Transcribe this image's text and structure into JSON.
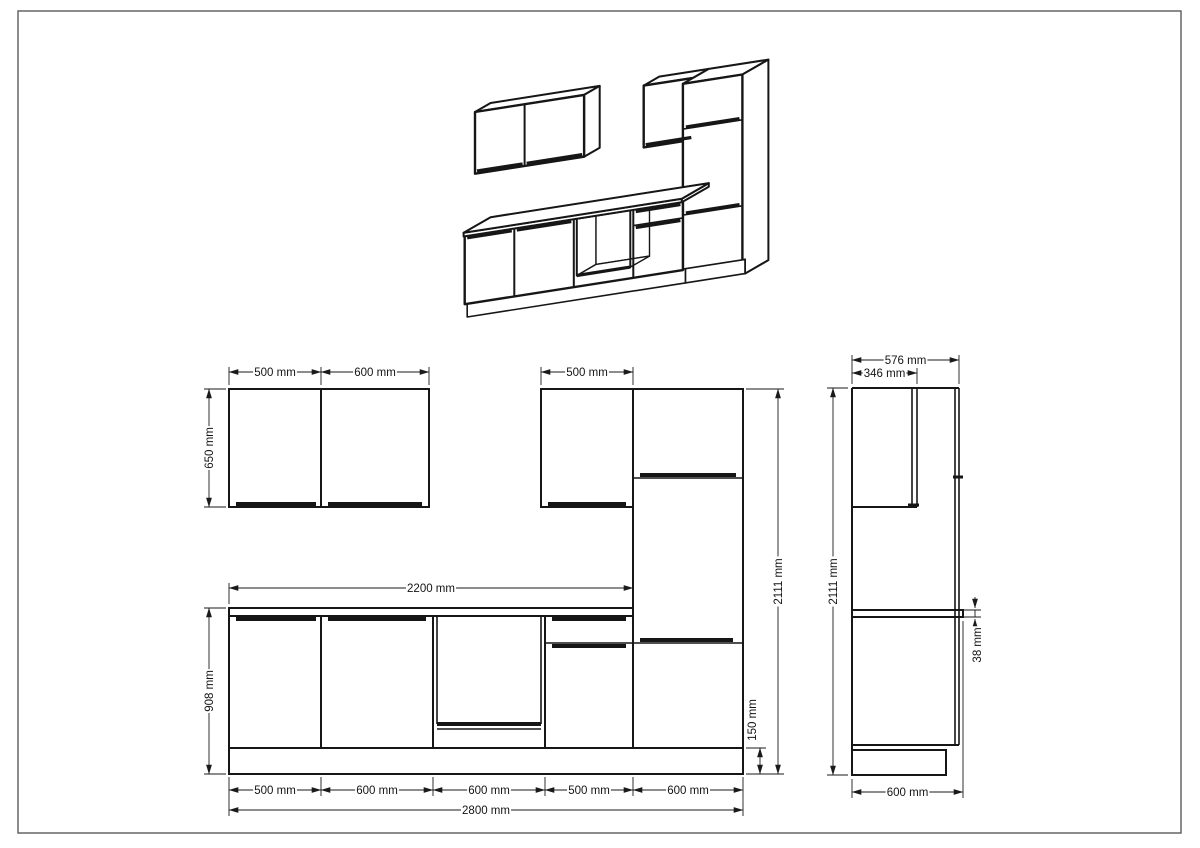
{
  "meta": {
    "title": "Kitchen cabinet set technical drawing",
    "views": [
      "oblique-3d-view",
      "front-elevation",
      "side-elevation"
    ]
  },
  "page": {
    "bg": "#ffffff",
    "border_color": "#5b5b5b",
    "ink": "#161616",
    "dim_ink": "#1a1a1a",
    "frame": [
      18,
      11,
      1163,
      822
    ],
    "font_size": 11.5
  },
  "dimensions": {
    "front_horizontal": [
      {
        "y": 372,
        "x1": 229,
        "x2": 321,
        "label": "500 mm"
      },
      {
        "y": 372,
        "x1": 321,
        "x2": 429,
        "label": "600 mm"
      },
      {
        "y": 372,
        "x1": 541,
        "x2": 633,
        "label": "500 mm"
      },
      {
        "y": 588,
        "x1": 229,
        "x2": 633,
        "label": "2200 mm"
      },
      {
        "y": 790,
        "x1": 229,
        "x2": 321,
        "label": "500 mm"
      },
      {
        "y": 790,
        "x1": 321,
        "x2": 433,
        "label": "600 mm"
      },
      {
        "y": 790,
        "x1": 433,
        "x2": 545,
        "label": "600 mm"
      },
      {
        "y": 790,
        "x1": 545,
        "x2": 633,
        "label": "500 mm"
      },
      {
        "y": 790,
        "x1": 633,
        "x2": 743,
        "label": "600 mm"
      },
      {
        "y": 810,
        "x1": 229,
        "x2": 743,
        "label": "2800 mm"
      }
    ],
    "front_vertical": [
      {
        "x": 209,
        "y1": 389,
        "y2": 507,
        "label": "650 mm"
      },
      {
        "x": 209,
        "y1": 608,
        "y2": 774,
        "label": "908 mm"
      },
      {
        "x": 778,
        "y1": 389,
        "y2": 774,
        "label": "2111 mm"
      },
      {
        "x": 760,
        "y1": 748,
        "y2": 774,
        "label": "150 mm",
        "lx": 752,
        "ly": 720
      }
    ],
    "side_horizontal": [
      {
        "y": 360,
        "x1": 852,
        "x2": 959,
        "label": "576 mm"
      },
      {
        "y": 373,
        "x1": 852,
        "x2": 917,
        "label": "346 mm"
      },
      {
        "y": 792,
        "x1": 852,
        "x2": 963,
        "label": "600 mm"
      }
    ],
    "side_vertical": [
      {
        "x": 833,
        "y1": 388,
        "y2": 775,
        "label": "2111 mm"
      },
      {
        "x": 975,
        "y1": 610,
        "y2": 617,
        "label": "38 mm",
        "lx": 977,
        "ly": 645,
        "outside": true
      }
    ]
  },
  "extensions": [
    [
      229,
      385,
      229,
      367
    ],
    [
      321,
      385,
      321,
      367
    ],
    [
      429,
      385,
      429,
      367
    ],
    [
      541,
      385,
      541,
      367
    ],
    [
      633,
      385,
      633,
      367
    ],
    [
      229,
      604,
      229,
      583
    ],
    [
      633,
      604,
      633,
      583
    ],
    [
      226,
      389,
      204,
      389
    ],
    [
      226,
      507,
      204,
      507
    ],
    [
      226,
      608,
      204,
      608
    ],
    [
      226,
      774,
      204,
      774
    ],
    [
      746,
      389,
      784,
      389
    ],
    [
      746,
      774,
      784,
      774
    ],
    [
      746,
      748,
      766,
      748
    ],
    [
      229,
      777,
      229,
      816
    ],
    [
      321,
      777,
      321,
      796
    ],
    [
      433,
      777,
      433,
      796
    ],
    [
      545,
      777,
      545,
      796
    ],
    [
      633,
      777,
      633,
      796
    ],
    [
      743,
      777,
      743,
      816
    ],
    [
      852,
      384,
      852,
      355
    ],
    [
      959,
      384,
      959,
      355
    ],
    [
      917,
      384,
      917,
      368
    ],
    [
      848,
      388,
      827,
      388
    ],
    [
      848,
      775,
      827,
      775
    ],
    [
      852,
      779,
      852,
      798
    ],
    [
      963,
      621,
      963,
      798
    ],
    [
      963,
      610,
      981,
      610
    ],
    [
      963,
      617,
      981,
      617
    ]
  ],
  "arrow_stubs": [
    [
      975,
      597,
      975,
      608
    ],
    [
      975,
      630,
      975,
      619
    ]
  ],
  "front_view": {
    "rects": [
      [
        229,
        389,
        92,
        118
      ],
      [
        321,
        389,
        108,
        118
      ],
      [
        541,
        389,
        92,
        118
      ],
      [
        633,
        389,
        110,
        359
      ],
      [
        229,
        616,
        92,
        132
      ],
      [
        321,
        616,
        112,
        132
      ],
      [
        433,
        616,
        112,
        132
      ],
      [
        545,
        616,
        88,
        132
      ],
      [
        229,
        608,
        404,
        8
      ],
      [
        229,
        748,
        514,
        26
      ]
    ],
    "lines": [
      [
        437,
        616,
        437,
        724,
        1.6
      ],
      [
        541,
        616,
        541,
        724,
        1.6
      ],
      [
        437,
        729,
        541,
        729,
        1.6
      ],
      [
        545,
        643,
        633,
        643,
        1.6
      ],
      [
        633,
        478,
        743,
        478,
        1.6
      ],
      [
        633,
        643,
        743,
        643,
        1.6
      ]
    ],
    "thick": [
      [
        437,
        724,
        541,
        724,
        4
      ],
      [
        236,
        504,
        316,
        504,
        4
      ],
      [
        328,
        504,
        422,
        504,
        4
      ],
      [
        548,
        504,
        626,
        504,
        4
      ],
      [
        236,
        619,
        316,
        619,
        4
      ],
      [
        328,
        619,
        426,
        619,
        4
      ],
      [
        552,
        619,
        626,
        619,
        4
      ],
      [
        552,
        646,
        626,
        646,
        4
      ],
      [
        640,
        475,
        736,
        475,
        4
      ],
      [
        640,
        640,
        733,
        640,
        4
      ]
    ]
  },
  "side_view": {
    "rects": [
      [
        852,
        610,
        111,
        7
      ],
      [
        852,
        750,
        94,
        25
      ]
    ],
    "lines": [
      [
        852,
        388,
        852,
        775,
        2
      ],
      [
        852,
        388,
        959,
        388,
        2
      ],
      [
        912,
        388,
        912,
        507,
        1.6
      ],
      [
        917,
        388,
        917,
        507,
        1.6
      ],
      [
        852,
        507,
        917,
        507,
        2
      ],
      [
        955,
        388,
        955,
        745,
        1.6
      ],
      [
        959,
        388,
        959,
        745,
        1.6
      ],
      [
        852,
        745,
        959,
        745,
        2
      ]
    ],
    "thick": [
      [
        908,
        505,
        919,
        505,
        3
      ],
      [
        953,
        477,
        963,
        477,
        3
      ]
    ]
  },
  "iso_view": {
    "origin": [
      490.6,
      303.5
    ],
    "ux": [
      0.0992,
      -0.0155
    ],
    "uy": [
      -0.045,
      0.026
    ],
    "uz": [
      0,
      -0.095
    ],
    "faces": [
      {
        "pts": [
          [
            0,
            0,
            2111
          ],
          [
            1100,
            0,
            2111
          ],
          [
            1100,
            346,
            2111
          ],
          [
            0,
            346,
            2111
          ]
        ],
        "w": 2
      },
      {
        "pts": [
          [
            1100,
            0,
            2111
          ],
          [
            1100,
            346,
            2111
          ],
          [
            1100,
            346,
            1461
          ],
          [
            1100,
            0,
            1461
          ]
        ],
        "w": 2
      },
      {
        "pts": [
          [
            0,
            346,
            2111
          ],
          [
            1100,
            346,
            2111
          ],
          [
            1100,
            346,
            1461
          ],
          [
            0,
            346,
            1461
          ]
        ],
        "w": 2.4
      },
      {
        "pts": [
          [
            1700,
            0,
            2111
          ],
          [
            2200,
            0,
            2111
          ],
          [
            2200,
            346,
            2111
          ],
          [
            1700,
            346,
            2111
          ]
        ],
        "w": 2
      },
      {
        "pts": [
          [
            2200,
            0,
            2111
          ],
          [
            2200,
            346,
            2111
          ],
          [
            2200,
            346,
            1461
          ],
          [
            2200,
            0,
            1461
          ]
        ],
        "w": 2
      },
      {
        "pts": [
          [
            1700,
            346,
            2111
          ],
          [
            2200,
            346,
            2111
          ],
          [
            2200,
            346,
            1461
          ],
          [
            1700,
            346,
            1461
          ]
        ],
        "w": 2.4
      },
      {
        "pts": [
          [
            2200,
            0,
            2111
          ],
          [
            2800,
            0,
            2111
          ],
          [
            2800,
            576,
            2111
          ],
          [
            2200,
            576,
            2111
          ]
        ],
        "w": 2
      },
      {
        "pts": [
          [
            2800,
            0,
            2111
          ],
          [
            2800,
            576,
            2111
          ],
          [
            2800,
            576,
            150
          ],
          [
            2800,
            520,
            150
          ],
          [
            2800,
            520,
            0
          ],
          [
            2800,
            0,
            0
          ]
        ],
        "w": 2
      },
      {
        "pts": [
          [
            2200,
            576,
            2111
          ],
          [
            2800,
            576,
            2111
          ],
          [
            2800,
            576,
            150
          ],
          [
            2200,
            576,
            150
          ]
        ],
        "w": 2.4
      },
      {
        "pts": [
          [
            2200,
            520,
            150
          ],
          [
            2800,
            520,
            150
          ],
          [
            2800,
            520,
            0
          ],
          [
            2200,
            520,
            0
          ]
        ],
        "w": 1.6
      },
      {
        "pts": [
          [
            0,
            520,
            150
          ],
          [
            2200,
            520,
            150
          ],
          [
            2200,
            520,
            0
          ],
          [
            0,
            520,
            0
          ]
        ],
        "w": 1.6
      },
      {
        "pts": [
          [
            0,
            576,
            870
          ],
          [
            2200,
            576,
            870
          ],
          [
            2200,
            576,
            150
          ],
          [
            0,
            576,
            150
          ]
        ],
        "w": 2.4
      },
      {
        "pts": [
          [
            1130,
            150,
            866
          ],
          [
            1670,
            150,
            866
          ],
          [
            1670,
            150,
            268
          ],
          [
            1130,
            150,
            268
          ]
        ],
        "w": 1.4
      },
      {
        "pts": [
          [
            1130,
            576,
            268
          ],
          [
            1670,
            576,
            268
          ],
          [
            1670,
            150,
            268
          ],
          [
            1130,
            150,
            268
          ]
        ],
        "w": 1.4
      },
      {
        "pts": [
          [
            1130,
            576,
            866
          ],
          [
            1130,
            576,
            268
          ],
          [
            1130,
            150,
            268
          ],
          [
            1130,
            150,
            866
          ]
        ],
        "w": 1.4
      },
      {
        "pts": [
          [
            1130,
            576,
            866
          ],
          [
            1670,
            576,
            866
          ],
          [
            1670,
            576,
            268
          ],
          [
            1130,
            576,
            268
          ]
        ],
        "w": 2,
        "open": true
      },
      {
        "pts": [
          [
            0,
            600,
            908
          ],
          [
            2200,
            600,
            908
          ],
          [
            2200,
            600,
            870
          ],
          [
            0,
            600,
            870
          ]
        ],
        "w": 2
      },
      {
        "pts": [
          [
            2200,
            0,
            908
          ],
          [
            2200,
            600,
            908
          ],
          [
            2200,
            600,
            870
          ],
          [
            2200,
            0,
            870
          ]
        ],
        "w": 2
      },
      {
        "pts": [
          [
            0,
            0,
            908
          ],
          [
            2200,
            0,
            908
          ],
          [
            2200,
            600,
            908
          ],
          [
            0,
            600,
            908
          ]
        ],
        "w": 2
      }
    ],
    "lines": [
      {
        "p1": [
          500,
          346,
          2111
        ],
        "p2": [
          500,
          346,
          1461
        ],
        "w": 2
      },
      {
        "p1": [
          20,
          346,
          1486
        ],
        "p2": [
          480,
          346,
          1486
        ],
        "w": 3.2
      },
      {
        "p1": [
          520,
          346,
          1486
        ],
        "p2": [
          1080,
          346,
          1486
        ],
        "w": 3.2
      },
      {
        "p1": [
          1720,
          346,
          1486
        ],
        "p2": [
          2180,
          346,
          1486
        ],
        "w": 3.2
      },
      {
        "p1": [
          2200,
          576,
          1634
        ],
        "p2": [
          2800,
          576,
          1634
        ],
        "w": 1.6
      },
      {
        "p1": [
          2230,
          576,
          1652
        ],
        "p2": [
          2770,
          576,
          1652
        ],
        "w": 3.2
      },
      {
        "p1": [
          2200,
          576,
          729
        ],
        "p2": [
          2800,
          576,
          729
        ],
        "w": 1.6
      },
      {
        "p1": [
          2230,
          576,
          747
        ],
        "p2": [
          2770,
          576,
          747
        ],
        "w": 3.2
      },
      {
        "p1": [
          500,
          576,
          870
        ],
        "p2": [
          500,
          576,
          150
        ],
        "w": 2
      },
      {
        "p1": [
          1100,
          576,
          870
        ],
        "p2": [
          1100,
          576,
          150
        ],
        "w": 2
      },
      {
        "p1": [
          1700,
          576,
          870
        ],
        "p2": [
          1700,
          576,
          150
        ],
        "w": 2
      },
      {
        "p1": [
          25,
          576,
          845
        ],
        "p2": [
          475,
          576,
          845
        ],
        "w": 3.2
      },
      {
        "p1": [
          525,
          576,
          845
        ],
        "p2": [
          1075,
          576,
          845
        ],
        "w": 3.2
      },
      {
        "p1": [
          1725,
          576,
          845
        ],
        "p2": [
          2175,
          576,
          845
        ],
        "w": 3.2
      },
      {
        "p1": [
          1700,
          576,
          700
        ],
        "p2": [
          2200,
          576,
          700
        ],
        "w": 1.6
      },
      {
        "p1": [
          1725,
          576,
          676
        ],
        "p2": [
          2175,
          576,
          676
        ],
        "w": 3.2
      },
      {
        "p1": [
          1130,
          576,
          268
        ],
        "p2": [
          1670,
          576,
          268
        ],
        "w": 3.2
      }
    ]
  }
}
